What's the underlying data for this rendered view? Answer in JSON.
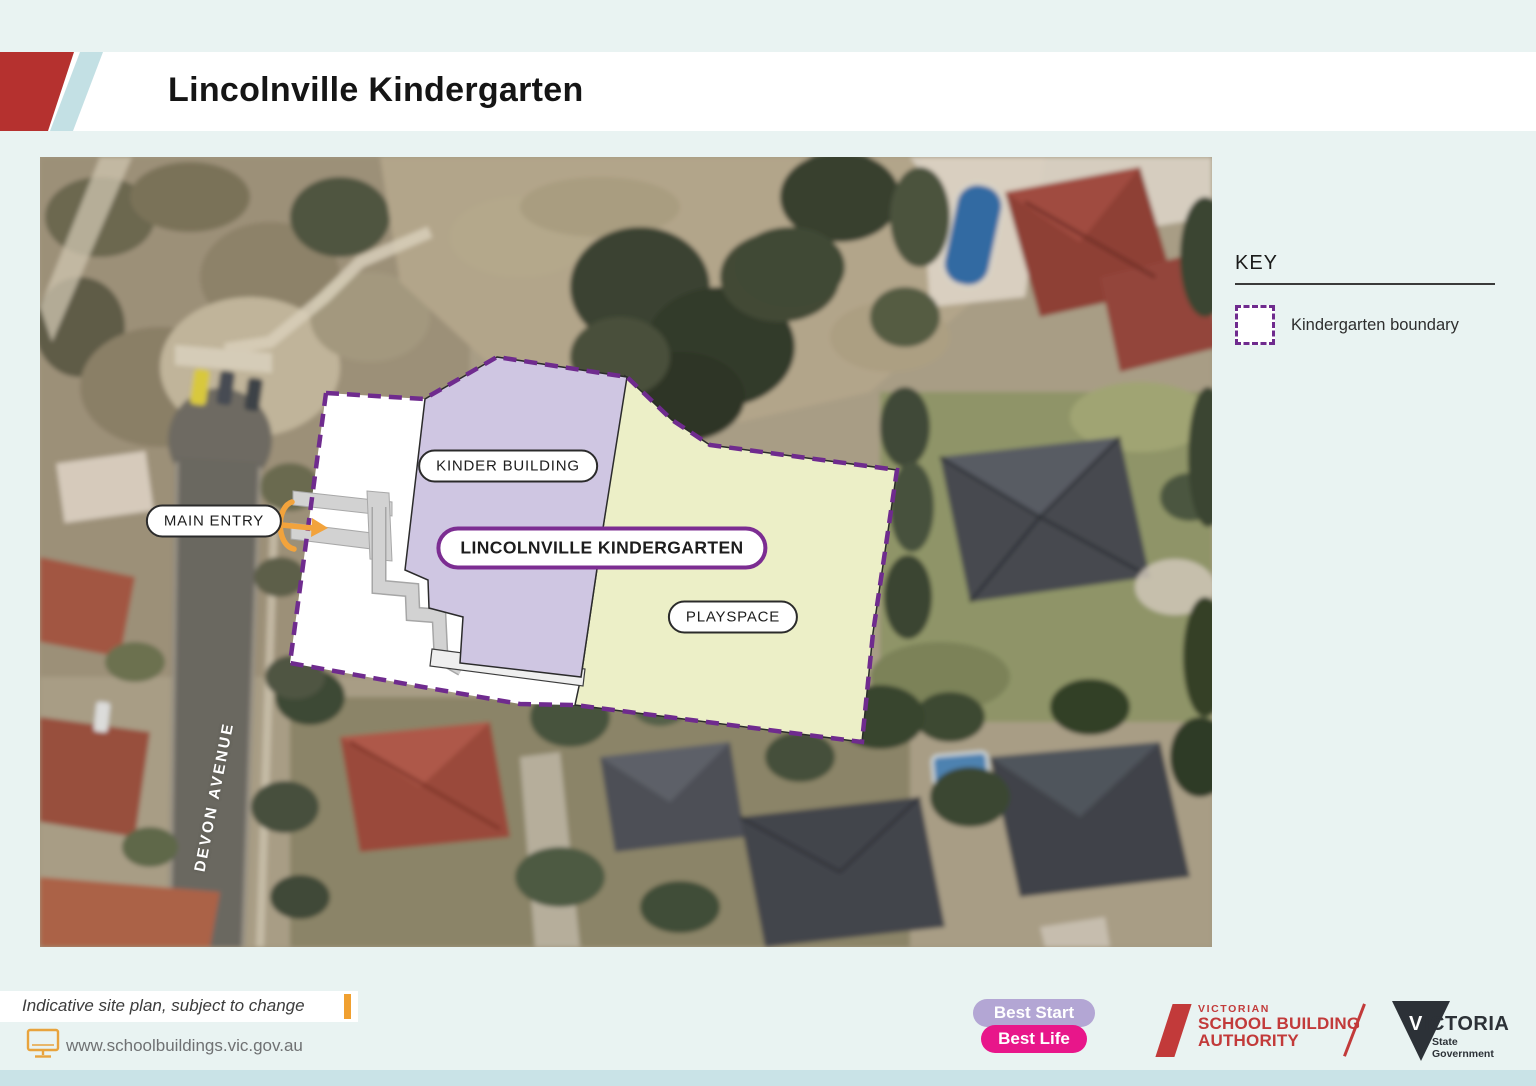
{
  "header": {
    "title": "Lincolnville Kindergarten"
  },
  "map": {
    "labels": {
      "kinder_building": "KINDER BUILDING",
      "site_name": "LINCOLNVILLE KINDERGARTEN",
      "playspace": "PLAYSPACE",
      "main_entry": "MAIN ENTRY",
      "street": "DEVON AVENUE"
    }
  },
  "key": {
    "title": "KEY",
    "items": [
      {
        "swatch": "kindergarten-boundary-dashed-square",
        "label": "Kindergarten boundary"
      }
    ]
  },
  "footer": {
    "disclaimer": "Indicative site plan, subject to change",
    "website": "www.schoolbuildings.vic.gov.au",
    "logos": {
      "best_start": {
        "line1": "Best Start",
        "line2": "Best Life"
      },
      "vsba": {
        "line1": "VICTORIAN",
        "line2": "SCHOOL BUILDING",
        "line3": "AUTHORITY"
      },
      "victoria": {
        "v": "V",
        "rest": "ICTORIA",
        "sub1": "State",
        "sub2": "Government"
      }
    }
  },
  "colors": {
    "page_bg": "#e9f3f2",
    "header_bg": "#ffffff",
    "header_red": "#b5312f",
    "header_teal": "#c3e0e4",
    "boundary_purple": "#6f2b8e",
    "site_name_border": "#7c2d92",
    "kinder_building_fill": "#cfc6e2",
    "playspace_fill": "#ecefc7",
    "path_gray": "#d2d2d2",
    "entry_arrow_orange": "#f2a33c",
    "accent_orange": "#f0a030",
    "url_text": "#6f7173",
    "footer_band": "#c9e3e7",
    "best_start_purple": "#b3a6d4",
    "best_life_pink": "#e8168a",
    "vsba_red": "#c23a3a",
    "victoria_navy": "#2c3137"
  }
}
